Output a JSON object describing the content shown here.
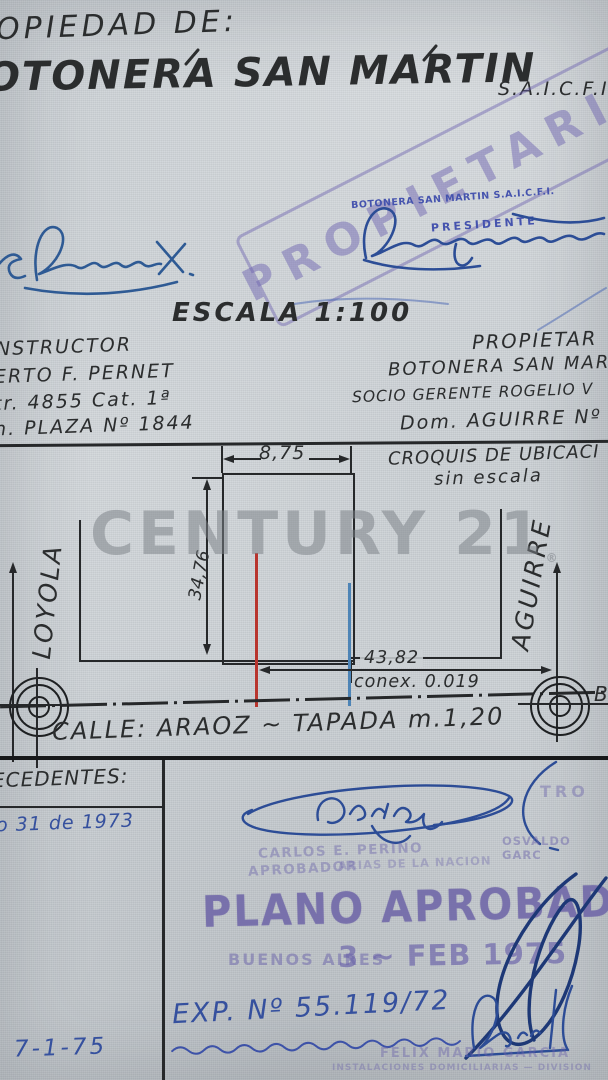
{
  "header": {
    "property_of": "OPIEDAD DE:",
    "company": "OTONERA SAN MARTIN",
    "company_suffix": "S.A.I.C.F.I"
  },
  "stamp": {
    "diagonal": "PROPIETARIO",
    "company_line": "BOTONERA SAN MARTIN S.A.I.C.F.I.",
    "role": "PRESIDENTE"
  },
  "scale": {
    "heading": "ESCALA 1:100"
  },
  "builder": {
    "title": "NSTRUCTOR",
    "line1": "ERTO F. PERNET",
    "line2": "tr. 4855 Cat. 1ª",
    "line3": "n. PLAZA Nº 1844"
  },
  "owner": {
    "title": "PROPIETAR",
    "line1": "BOTONERA SAN MARTIN",
    "line2": "SOCIO GERENTE ROGELIO V",
    "line3": "Dom. AGUIRRE Nº"
  },
  "sketch": {
    "caption1": "CROQUIS DE UBICACI",
    "caption2": "sin escala",
    "dim_width": "8,75",
    "dim_depth": "34,76",
    "dim_distance": "43,82",
    "connection": "conex. 0.019",
    "street_left": "LOYOLA",
    "street_right": "AGUIRRE",
    "street_bottom": "CALLE: ARAOZ ~ TAPADA m.1,20",
    "corner_label": "B-",
    "colors": {
      "red_line": "#b8352e",
      "blue_line": "#4d84b6",
      "ink_black": "#26282a"
    }
  },
  "watermark": {
    "text": "CENTURY 21",
    "mark": "®"
  },
  "footer": {
    "antecedentes": "ECEDENTES:",
    "entry_1973": "o 31 de 1973",
    "date_note": "7-1-75",
    "perino_name": "CARLOS E. PERINO",
    "perino_role": "APROBADOR",
    "nacion_fragment": "ARIAS DE LA NACION",
    "registro_fragment": "TRO",
    "osvaldo": "OSVALDO GARC",
    "plano_aprobado": "PLANO APROBADO",
    "buenos_aires": "BUENOS AIRES",
    "date_stamp": "3 ~ FEB 1975",
    "expediente": "EXP. Nº 55.119/72",
    "garcia_name": "FELIX MARIO GARCIA",
    "garcia_dept": "INSTALACIONES DOMICILIARIAS — DIVISION",
    "stamp_purple": "#6c64ac",
    "ink_blue": "#35509e"
  }
}
